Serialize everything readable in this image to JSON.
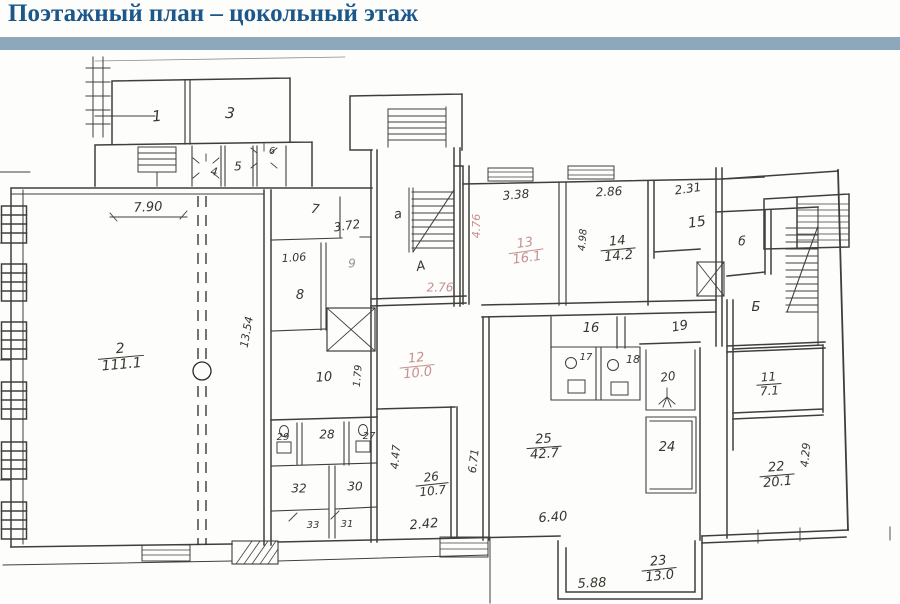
{
  "header": {
    "title": "Поэтажный план – цокольный этаж",
    "title_color": "#1c578a",
    "bar_color": "#8ea8bb"
  },
  "plan": {
    "ink_color": "#38352f",
    "faded_color": "#c6908e",
    "labels": [
      {
        "name": "room-1",
        "type": "room",
        "text": "1",
        "x": 157,
        "y": 117,
        "fs": 15,
        "rot": -6
      },
      {
        "name": "room-3",
        "type": "room",
        "text": "3",
        "x": 230,
        "y": 114,
        "fs": 15,
        "rot": 5
      },
      {
        "name": "room-4",
        "type": "room",
        "text": "4",
        "x": 214,
        "y": 172,
        "fs": 11,
        "rot": 8
      },
      {
        "name": "room-5",
        "type": "room",
        "text": "5",
        "x": 238,
        "y": 167,
        "fs": 12,
        "rot": 0
      },
      {
        "name": "room-6",
        "type": "room",
        "text": "6",
        "x": 272,
        "y": 152,
        "fs": 10,
        "rot": 0
      },
      {
        "name": "room-7",
        "type": "room",
        "text": "7",
        "x": 315,
        "y": 210,
        "fs": 13,
        "rot": 8
      },
      {
        "name": "room-8",
        "type": "room",
        "text": "8",
        "x": 300,
        "y": 296,
        "fs": 13,
        "rot": 0
      },
      {
        "name": "room-9",
        "type": "room",
        "text": "9",
        "x": 352,
        "y": 264,
        "fs": 12,
        "rot": 0,
        "color": "gray"
      },
      {
        "name": "room-10",
        "type": "room",
        "text": "10",
        "x": 324,
        "y": 378,
        "fs": 13,
        "rot": -4
      },
      {
        "name": "room-15",
        "type": "room",
        "text": "15",
        "x": 697,
        "y": 223,
        "fs": 14,
        "rot": -8
      },
      {
        "name": "room-16",
        "type": "room",
        "text": "16",
        "x": 591,
        "y": 329,
        "fs": 13,
        "rot": 0
      },
      {
        "name": "room-17",
        "type": "room",
        "text": "17",
        "x": 586,
        "y": 358,
        "fs": 10,
        "rot": 0
      },
      {
        "name": "room-18",
        "type": "room",
        "text": "18",
        "x": 633,
        "y": 360,
        "fs": 11,
        "rot": 0
      },
      {
        "name": "room-19",
        "type": "room",
        "text": "19",
        "x": 680,
        "y": 327,
        "fs": 13,
        "rot": -10
      },
      {
        "name": "room-20",
        "type": "room",
        "text": "20",
        "x": 668,
        "y": 377,
        "fs": 12,
        "rot": -8
      },
      {
        "name": "room-24",
        "type": "room",
        "text": "24",
        "x": 667,
        "y": 448,
        "fs": 13,
        "rot": 0
      },
      {
        "name": "room-27",
        "type": "room",
        "text": "27",
        "x": 369,
        "y": 437,
        "fs": 10,
        "rot": 0
      },
      {
        "name": "room-28",
        "type": "room",
        "text": "28",
        "x": 327,
        "y": 435,
        "fs": 12,
        "rot": 0
      },
      {
        "name": "room-29",
        "type": "room",
        "text": "29",
        "x": 283,
        "y": 438,
        "fs": 10,
        "rot": 0
      },
      {
        "name": "room-30",
        "type": "room",
        "text": "30",
        "x": 355,
        "y": 487,
        "fs": 12,
        "rot": 0
      },
      {
        "name": "room-31",
        "type": "room",
        "text": "31",
        "x": 347,
        "y": 525,
        "fs": 10,
        "rot": 0
      },
      {
        "name": "room-32",
        "type": "room",
        "text": "32",
        "x": 299,
        "y": 489,
        "fs": 12,
        "rot": 0
      },
      {
        "name": "room-33",
        "type": "room",
        "text": "33",
        "x": 313,
        "y": 526,
        "fs": 10,
        "rot": 0
      },
      {
        "name": "room-2",
        "type": "fraction",
        "num": "2",
        "den": "111.1",
        "x": 121,
        "y": 357,
        "fs": 14,
        "rot": -5
      },
      {
        "name": "room-11",
        "type": "fraction",
        "num": "11",
        "den": "7.1",
        "x": 769,
        "y": 384,
        "fs": 12,
        "rot": -4
      },
      {
        "name": "room-12",
        "type": "fraction",
        "num": "12",
        "den": "10.0",
        "x": 417,
        "y": 366,
        "fs": 13,
        "rot": -6,
        "color": "pink"
      },
      {
        "name": "room-13",
        "type": "fraction",
        "num": "13",
        "den": "16.1",
        "x": 526,
        "y": 251,
        "fs": 13,
        "rot": -8,
        "color": "pink"
      },
      {
        "name": "room-14",
        "type": "fraction",
        "num": "14",
        "den": "14.2",
        "x": 618,
        "y": 249,
        "fs": 13,
        "rot": -5
      },
      {
        "name": "room-22",
        "type": "fraction",
        "num": "22",
        "den": "20.1",
        "x": 777,
        "y": 475,
        "fs": 13,
        "rot": -5
      },
      {
        "name": "room-23",
        "type": "fraction",
        "num": "23",
        "den": "13.0",
        "x": 659,
        "y": 569,
        "fs": 13,
        "rot": -6
      },
      {
        "name": "room-25",
        "type": "fraction",
        "num": "25",
        "den": "42.7",
        "x": 544,
        "y": 447,
        "fs": 13,
        "rot": -4
      },
      {
        "name": "room-26",
        "type": "fraction",
        "num": "26",
        "den": "10.7",
        "x": 432,
        "y": 484,
        "fs": 12,
        "rot": -6
      },
      {
        "name": "dim-7-90",
        "type": "dim",
        "text": "7.90",
        "x": 148,
        "y": 208,
        "fs": 13,
        "rot": -3
      },
      {
        "name": "dim-3-72",
        "type": "dim",
        "text": "3.72",
        "x": 347,
        "y": 226,
        "fs": 12,
        "rot": -8
      },
      {
        "name": "dim-1-06",
        "type": "dim",
        "text": "1.06",
        "x": 294,
        "y": 258,
        "fs": 11,
        "rot": -4
      },
      {
        "name": "dim-1-79",
        "type": "dim",
        "text": "1.79",
        "x": 359,
        "y": 376,
        "fs": 10,
        "rot": -85
      },
      {
        "name": "dim-13-54",
        "type": "dim",
        "text": "13.54",
        "x": 247,
        "y": 332,
        "fs": 11,
        "rot": -80
      },
      {
        "name": "dim-3-38",
        "type": "dim",
        "text": "3.38",
        "x": 516,
        "y": 195,
        "fs": 12,
        "rot": -5
      },
      {
        "name": "dim-2-86",
        "type": "dim",
        "text": "2.86",
        "x": 609,
        "y": 192,
        "fs": 12,
        "rot": -3
      },
      {
        "name": "dim-4-98",
        "type": "dim",
        "text": "4.98",
        "x": 584,
        "y": 240,
        "fs": 10,
        "rot": -85
      },
      {
        "name": "dim-2-31",
        "type": "dim",
        "text": "2.31",
        "x": 688,
        "y": 189,
        "fs": 12,
        "rot": -8
      },
      {
        "name": "dim-2-76",
        "type": "dim",
        "text": "2.76",
        "x": 440,
        "y": 288,
        "fs": 12,
        "rot": 0,
        "color": "pink"
      },
      {
        "name": "dim-4-76",
        "type": "dim",
        "text": "4.76",
        "x": 477,
        "y": 226,
        "fs": 11,
        "rot": -90,
        "color": "pink"
      },
      {
        "name": "dim-4-47",
        "type": "dim",
        "text": "4.47",
        "x": 396,
        "y": 457,
        "fs": 11,
        "rot": -85
      },
      {
        "name": "dim-6-71",
        "type": "dim",
        "text": "6.71",
        "x": 474,
        "y": 461,
        "fs": 11,
        "rot": -83
      },
      {
        "name": "dim-2-42",
        "type": "dim",
        "text": "2.42",
        "x": 424,
        "y": 525,
        "fs": 13,
        "rot": -5
      },
      {
        "name": "dim-6-40",
        "type": "dim",
        "text": "6.40",
        "x": 553,
        "y": 518,
        "fs": 13,
        "rot": -4
      },
      {
        "name": "dim-4-29",
        "type": "dim",
        "text": "4.29",
        "x": 806,
        "y": 455,
        "fs": 11,
        "rot": -85
      },
      {
        "name": "dim-5-88",
        "type": "dim",
        "text": "5.88",
        "x": 592,
        "y": 584,
        "fs": 13,
        "rot": -3
      },
      {
        "name": "stair-letter-a-small",
        "type": "letter",
        "text": "а",
        "x": 398,
        "y": 215,
        "fs": 13,
        "rot": -10
      },
      {
        "name": "stair-letter-a",
        "type": "letter",
        "text": "А",
        "x": 421,
        "y": 267,
        "fs": 13,
        "rot": -12
      },
      {
        "name": "stair-letter-b-small",
        "type": "letter",
        "text": "б",
        "x": 742,
        "y": 242,
        "fs": 12,
        "rot": 0
      },
      {
        "name": "stair-letter-b",
        "type": "letter",
        "text": "Б",
        "x": 756,
        "y": 308,
        "fs": 13,
        "rot": 0
      }
    ]
  }
}
